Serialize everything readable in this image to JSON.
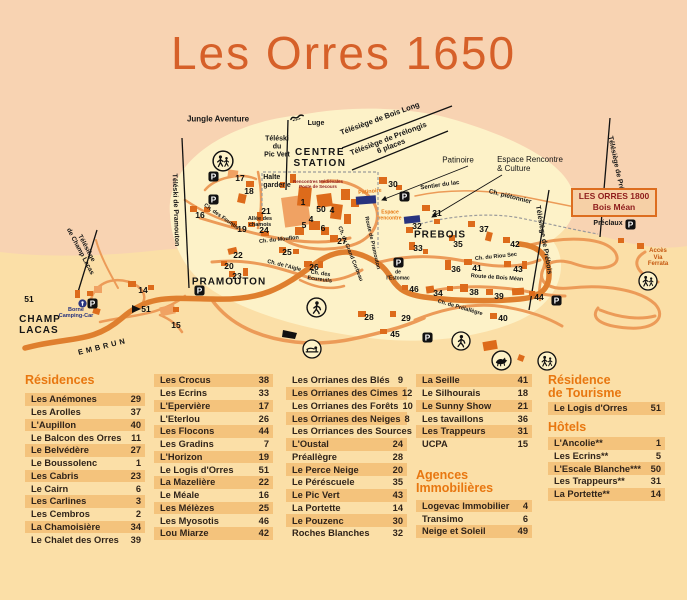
{
  "title": "Les Orres 1650",
  "colors": {
    "peach": "#f8d3b2",
    "sand": "#fbdfa7",
    "cream": "#fdf2c8",
    "title_orange": "#d66029",
    "header_orange": "#e87710",
    "stripe": "#f4c37c",
    "road_main": "#df7f2e",
    "road_secondary": "#ec9b58",
    "building_dark": "#dd6b1b",
    "building_light": "#f0a263",
    "dark_red": "#8e1c1c",
    "navy": "#27337f"
  },
  "map": {
    "box_1800": {
      "line1": "LES ORRES 1800",
      "line2": "Bois Méan"
    },
    "labels": [
      {
        "t": "Jungle Aventure",
        "x": 218,
        "y": 120,
        "s": 8
      },
      {
        "t": "Luge",
        "x": 316,
        "y": 124,
        "s": 7
      },
      {
        "t": "Téléski\ndu\nPic Vert",
        "x": 277,
        "y": 147,
        "s": 7
      },
      {
        "t": "CENTRE\nSTATION",
        "x": 320,
        "y": 158,
        "s": 10,
        "ls": 1.5
      },
      {
        "t": "Rencontres Médiévales\nPoste de Secours",
        "x": 318,
        "y": 184,
        "s": 4.5,
        "c": "#8e1c1c"
      },
      {
        "t": "Halte\ngarderie",
        "x": 277,
        "y": 182,
        "s": 7,
        "al": "left"
      },
      {
        "t": "Télésiège de Bois Long",
        "x": 380,
        "y": 119,
        "s": 7.5,
        "r": -20
      },
      {
        "t": "Télésiège de Prélongis\n6 places",
        "x": 390,
        "y": 143,
        "s": 7.5,
        "r": -21
      },
      {
        "t": "Patinoire",
        "x": 458,
        "y": 161,
        "s": 8,
        "w": 400
      },
      {
        "t": "Espace Rencontre\n& Culture",
        "x": 530,
        "y": 165,
        "s": 8,
        "w": 400,
        "al": "left"
      },
      {
        "t": "Patinoire",
        "x": 370,
        "y": 192,
        "s": 5.5,
        "c": "#e87a16",
        "r": -6
      },
      {
        "t": "Espace\nrencontre",
        "x": 390,
        "y": 216,
        "s": 5,
        "c": "#e87a16"
      },
      {
        "t": "Sentier du lac",
        "x": 440,
        "y": 186,
        "s": 6,
        "r": -8
      },
      {
        "t": "Ch. piétonnier",
        "x": 510,
        "y": 197,
        "s": 6.5,
        "r": 14
      },
      {
        "t": "Télésiège de Préclaux",
        "x": 617,
        "y": 172,
        "s": 7,
        "r": 78
      },
      {
        "t": "Télésiège de Prébois",
        "x": 543,
        "y": 240,
        "s": 7,
        "r": 80
      },
      {
        "t": "Téléski de Pramouton",
        "x": 175,
        "y": 210,
        "s": 7,
        "r": 88
      },
      {
        "t": "Télésiège\nde Champ Lacas",
        "x": 83,
        "y": 250,
        "s": 6.5,
        "r": 62
      },
      {
        "t": "Préclaux",
        "x": 608,
        "y": 224,
        "s": 7
      },
      {
        "t": "Accès\nVia\nFerrata",
        "x": 658,
        "y": 258,
        "s": 6,
        "c": "#c4560e"
      },
      {
        "t": "PREBOIS",
        "x": 440,
        "y": 235,
        "s": 10,
        "ls": 1
      },
      {
        "t": "PRAMOUTON",
        "x": 229,
        "y": 282,
        "s": 10,
        "ls": 1
      },
      {
        "t": "CHAMP\nLACAS",
        "x": 40,
        "y": 325,
        "s": 10,
        "ls": 1,
        "al": "left"
      },
      {
        "t": "EMBRUN",
        "x": 103,
        "y": 347,
        "s": 7.5,
        "r": -14,
        "ls": 3
      },
      {
        "t": "Borne\nCamping-Car",
        "x": 76,
        "y": 313,
        "s": 5.5,
        "c": "#27337f"
      },
      {
        "t": "Ch. des Fountis",
        "x": 221,
        "y": 217,
        "s": 5.5,
        "r": 35
      },
      {
        "t": "Allée des\nchamois",
        "x": 260,
        "y": 222,
        "s": 5.5
      },
      {
        "t": "Ch. du Mouflon",
        "x": 279,
        "y": 240,
        "s": 5.5,
        "r": -6
      },
      {
        "t": "Ch. de l'Aigle",
        "x": 284,
        "y": 266,
        "s": 5.5,
        "r": 14
      },
      {
        "t": "Ch. des\nEcureuils",
        "x": 320,
        "y": 277,
        "s": 5.5,
        "r": 8
      },
      {
        "t": "Ch. du Grand Corbeau",
        "x": 350,
        "y": 254,
        "s": 5.5,
        "r": 68
      },
      {
        "t": "Route de Pramouton",
        "x": 372,
        "y": 243,
        "s": 5.5,
        "r": 77
      },
      {
        "t": "Ch. du Riou Sec",
        "x": 496,
        "y": 257,
        "s": 5.5,
        "r": -6
      },
      {
        "t": "Route de Bois Méan",
        "x": 497,
        "y": 278,
        "s": 5.5,
        "r": 4
      },
      {
        "t": "Ch. de Prélallègre",
        "x": 460,
        "y": 308,
        "s": 5.5,
        "r": 16
      },
      {
        "t": "de\nl'Estomac",
        "x": 398,
        "y": 276,
        "s": 5
      }
    ],
    "numbers": [
      {
        "n": "1",
        "x": 303,
        "y": 202
      },
      {
        "n": "50",
        "x": 321,
        "y": 209
      },
      {
        "n": "4",
        "x": 332,
        "y": 210
      },
      {
        "n": "4",
        "x": 311,
        "y": 219
      },
      {
        "n": "5",
        "x": 304,
        "y": 225
      },
      {
        "n": "6",
        "x": 323,
        "y": 228
      },
      {
        "n": "14",
        "x": 143,
        "y": 290
      },
      {
        "n": "15",
        "x": 176,
        "y": 325
      },
      {
        "n": "16",
        "x": 200,
        "y": 215
      },
      {
        "n": "17",
        "x": 240,
        "y": 178
      },
      {
        "n": "18",
        "x": 249,
        "y": 191
      },
      {
        "n": "19",
        "x": 242,
        "y": 229
      },
      {
        "n": "20",
        "x": 229,
        "y": 266
      },
      {
        "n": "21",
        "x": 266,
        "y": 211
      },
      {
        "n": "22",
        "x": 238,
        "y": 255
      },
      {
        "n": "23",
        "x": 237,
        "y": 276
      },
      {
        "n": "24",
        "x": 264,
        "y": 230
      },
      {
        "n": "25",
        "x": 287,
        "y": 252
      },
      {
        "n": "26",
        "x": 314,
        "y": 267
      },
      {
        "n": "27",
        "x": 342,
        "y": 241
      },
      {
        "n": "28",
        "x": 369,
        "y": 317
      },
      {
        "n": "29",
        "x": 406,
        "y": 318
      },
      {
        "n": "30",
        "x": 393,
        "y": 184
      },
      {
        "n": "31",
        "x": 437,
        "y": 213
      },
      {
        "n": "32",
        "x": 417,
        "y": 226
      },
      {
        "n": "33",
        "x": 418,
        "y": 248
      },
      {
        "n": "34",
        "x": 438,
        "y": 293
      },
      {
        "n": "35",
        "x": 458,
        "y": 244
      },
      {
        "n": "36",
        "x": 456,
        "y": 269
      },
      {
        "n": "37",
        "x": 484,
        "y": 229
      },
      {
        "n": "38",
        "x": 474,
        "y": 292
      },
      {
        "n": "39",
        "x": 499,
        "y": 296
      },
      {
        "n": "40",
        "x": 503,
        "y": 318
      },
      {
        "n": "41",
        "x": 477,
        "y": 268
      },
      {
        "n": "42",
        "x": 515,
        "y": 244
      },
      {
        "n": "43",
        "x": 518,
        "y": 269
      },
      {
        "n": "44",
        "x": 539,
        "y": 297
      },
      {
        "n": "45",
        "x": 395,
        "y": 334
      },
      {
        "n": "46",
        "x": 414,
        "y": 289
      },
      {
        "n": "51",
        "x": 29,
        "y": 299
      },
      {
        "n": "51",
        "x": 146,
        "y": 309
      }
    ],
    "icons": [
      {
        "name": "parking-icon",
        "x": 213,
        "y": 176,
        "d": 11
      },
      {
        "name": "parking-icon",
        "x": 213,
        "y": 199,
        "d": 11
      },
      {
        "name": "parking-icon",
        "x": 199,
        "y": 290,
        "d": 11
      },
      {
        "name": "parking-icon",
        "x": 92,
        "y": 303,
        "d": 11
      },
      {
        "name": "parking-icon",
        "x": 404,
        "y": 196,
        "d": 11
      },
      {
        "name": "parking-icon",
        "x": 398,
        "y": 262,
        "d": 11
      },
      {
        "name": "parking-icon",
        "x": 630,
        "y": 224,
        "d": 11
      },
      {
        "name": "parking-icon",
        "x": 556,
        "y": 300,
        "d": 11
      },
      {
        "name": "parking-icon",
        "x": 427,
        "y": 337,
        "d": 11
      },
      {
        "name": "borne-icon",
        "x": 82,
        "y": 303,
        "d": 9
      },
      {
        "name": "hikers-icon",
        "x": 223,
        "y": 161,
        "d": 22
      },
      {
        "name": "hikers-icon",
        "x": 648,
        "y": 281,
        "d": 20
      },
      {
        "name": "hikers-icon",
        "x": 547,
        "y": 361,
        "d": 20
      },
      {
        "name": "walker-icon",
        "x": 316,
        "y": 307,
        "d": 21
      },
      {
        "name": "walker-icon",
        "x": 461,
        "y": 341,
        "d": 20
      },
      {
        "name": "sled-icon",
        "x": 312,
        "y": 349,
        "d": 20
      },
      {
        "name": "horse-icon",
        "x": 501,
        "y": 360,
        "d": 21
      },
      {
        "name": "luge-icon",
        "x": 297,
        "y": 117,
        "d": 15
      }
    ]
  },
  "directory": {
    "columns": [
      {
        "x": 25,
        "w": 120,
        "sections": [
          {
            "title": "Résidences",
            "tmb": 6,
            "stripe": "odd",
            "rows": [
              [
                "Les Anémones",
                "29"
              ],
              [
                "Les Arolles",
                "37"
              ],
              [
                "L'Aupillon",
                "40"
              ],
              [
                "Le Balcon des Orres",
                "11"
              ],
              [
                "Le Belvédère",
                "27"
              ],
              [
                "Le Boussolenc",
                "1"
              ],
              [
                "Les Cabris",
                "23"
              ],
              [
                "Le Cairn",
                "6"
              ],
              [
                "Les Carlines",
                "3"
              ],
              [
                "Les Cembros",
                "2"
              ],
              [
                "La Chamoisière",
                "34"
              ],
              [
                "Le Chalet des Orres",
                "39"
              ]
            ]
          }
        ]
      },
      {
        "x": 154,
        "w": 119,
        "sections": [
          {
            "stripe": "odd",
            "rows": [
              [
                "Les Crocus",
                "38"
              ],
              [
                "Les Ecrins",
                "33"
              ],
              [
                "L'Epervière",
                "17"
              ],
              [
                "L'Eterlou",
                "26"
              ],
              [
                "Les Flocons",
                "44"
              ],
              [
                "Les Gradins",
                "7"
              ],
              [
                "L'Horizon",
                "19"
              ],
              [
                "Le Logis d'Orres",
                "51"
              ],
              [
                "La Mazelière",
                "22"
              ],
              [
                "Le Méale",
                "16"
              ],
              [
                "Les Mélèzes",
                "25"
              ],
              [
                "Les Myosotis",
                "46"
              ],
              [
                "Lou Miarze",
                "42"
              ]
            ]
          }
        ]
      },
      {
        "x": 286,
        "w": 121,
        "sections": [
          {
            "stripe": "even",
            "rows": [
              [
                "Les Orrianes des Blés",
                "9"
              ],
              [
                "Les Orrianes des Cimes",
                "12"
              ],
              [
                "Les Orrianes des Forêts",
                "10"
              ],
              [
                "Les Orrianes des Neiges",
                "8"
              ],
              [
                "Les Orriances des Sources",
                "13"
              ],
              [
                "L'Oustal",
                "24"
              ],
              [
                "Préallègre",
                "28"
              ],
              [
                "Le Perce Neige",
                "20"
              ],
              [
                "Le Péréscuele",
                "35"
              ],
              [
                "Le Pic Vert",
                "43"
              ],
              [
                "La Portette",
                "14"
              ],
              [
                "Le Pouzenc",
                "30"
              ],
              [
                "Roches Blanches",
                "32"
              ]
            ]
          }
        ]
      },
      {
        "x": 416,
        "w": 116,
        "sections": [
          {
            "stripe": "odd",
            "rows": [
              [
                "La Seille",
                "41"
              ],
              [
                "Le Silhourais",
                "18"
              ],
              [
                "Le Sunny Show",
                "21"
              ],
              [
                "Les tavaillons",
                "36"
              ],
              [
                "Les Trappeurs",
                "31"
              ],
              [
                "UCPA",
                "15"
              ]
            ]
          },
          {
            "title": "Agences\nImmobilières",
            "mt": 18,
            "tmb": 5,
            "stripe": "odd",
            "rows": [
              [
                "Logevac Immobilier",
                "4"
              ],
              [
                "Transimo",
                "6"
              ],
              [
                "Neige et Soleil",
                "49"
              ]
            ]
          }
        ]
      },
      {
        "x": 548,
        "w": 117,
        "sections": [
          {
            "title": "Résidence\nde Tourisme",
            "tmb": 2,
            "stripe": "odd",
            "rows": [
              [
                "Le Logis d'Orres",
                "51"
              ]
            ]
          },
          {
            "title": "Hôtels",
            "mt": 6,
            "tmb": 3,
            "stripe": "odd",
            "rows": [
              [
                "L'Ancolie**",
                "1"
              ],
              [
                "Les Ecrins**",
                "5"
              ],
              [
                "L'Escale Blanche***",
                "50"
              ],
              [
                "Les Trappeurs**",
                "31"
              ],
              [
                "La Portette**",
                "14"
              ]
            ]
          }
        ]
      }
    ]
  }
}
